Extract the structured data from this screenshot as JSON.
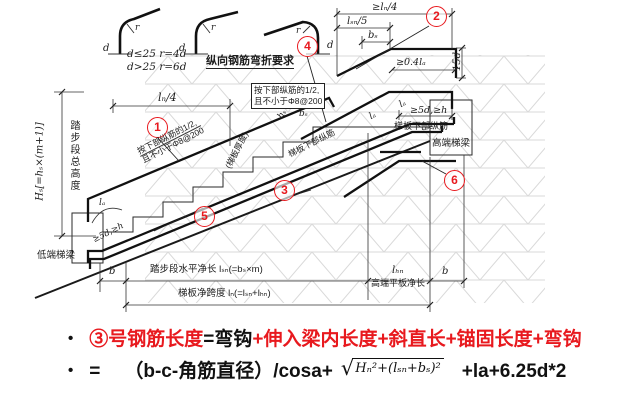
{
  "colors": {
    "accent_red": "#e8191e",
    "line": "#222222",
    "hatch": "#d2d2d2"
  },
  "bend_detail": {
    "d1": "d",
    "d2": "d",
    "d3": "d",
    "r1": "r",
    "r2": "r",
    "r3": "r",
    "rule1": "d≤25 r=4d",
    "rule2": "d>25 r=6d",
    "title": "纵向钢筋弯折要求"
  },
  "callouts": {
    "c1": "1",
    "c2": "2",
    "c3": "3",
    "c4": "4",
    "c5": "5",
    "c6": "6"
  },
  "dims": {
    "ln4": "lₙ/4",
    "ge_ln4": "≥lₙ/4",
    "lsn5": "lₛₙ/5",
    "bs_top": "bₛ",
    "bs_step": "bₛ",
    "hs_step": "hₛ",
    "d15": "15d",
    "ge04la": "≥0.4lₐ",
    "ge5dh_high": "≥5d,≥h",
    "ge5dh_low": "≥5d,≥h",
    "la_1": "lₐ",
    "la_2": "lₐ",
    "la_low": "lₐ",
    "b_left": "b",
    "b_right": "b",
    "lhn": "lₕₙ",
    "lsn_total": "踏步段水平净长 lₛₙ(=bₛ×m)",
    "lhn_label": "高端平板净长",
    "ln_total": "梯板净跨度 lₙ(=lₛₙ+lₕₙ)",
    "Hs": "Hₛ[=hₛ×(m+1)]",
    "Hs_cn": "踏步段总高度"
  },
  "labels": {
    "note_boxed_1": "按下部纵筋的1/2,",
    "note_boxed_2": "且不小于Φ8@200",
    "note_incline_1": "按下部纵筋的1/2,",
    "note_incline_2": "且不小于Φ8@200",
    "slab_thickness": "(梯板厚度)",
    "bottom_bars_incline": "梯板下部纵筋",
    "bottom_bars_high": "梯板下部纵筋",
    "high_beam": "高端梯梁",
    "low_beam": "低端梯梁"
  },
  "notes": {
    "line1": {
      "bullet": "•",
      "seg_red_1": "③号钢筋长度",
      "seg_black": "=弯钩",
      "seg_red_2": "+伸入梁内长度+斜直长+锚固长度+弯钩"
    },
    "line2": {
      "bullet": "•",
      "eq": "=",
      "part1": "（b-c-角筋直径）/cosa+",
      "sqrt_sign": "√",
      "sqrt_expr": "Hₙ²+(lₛₙ+bₛ)²",
      "part2": "+la+6.25d*2"
    }
  }
}
